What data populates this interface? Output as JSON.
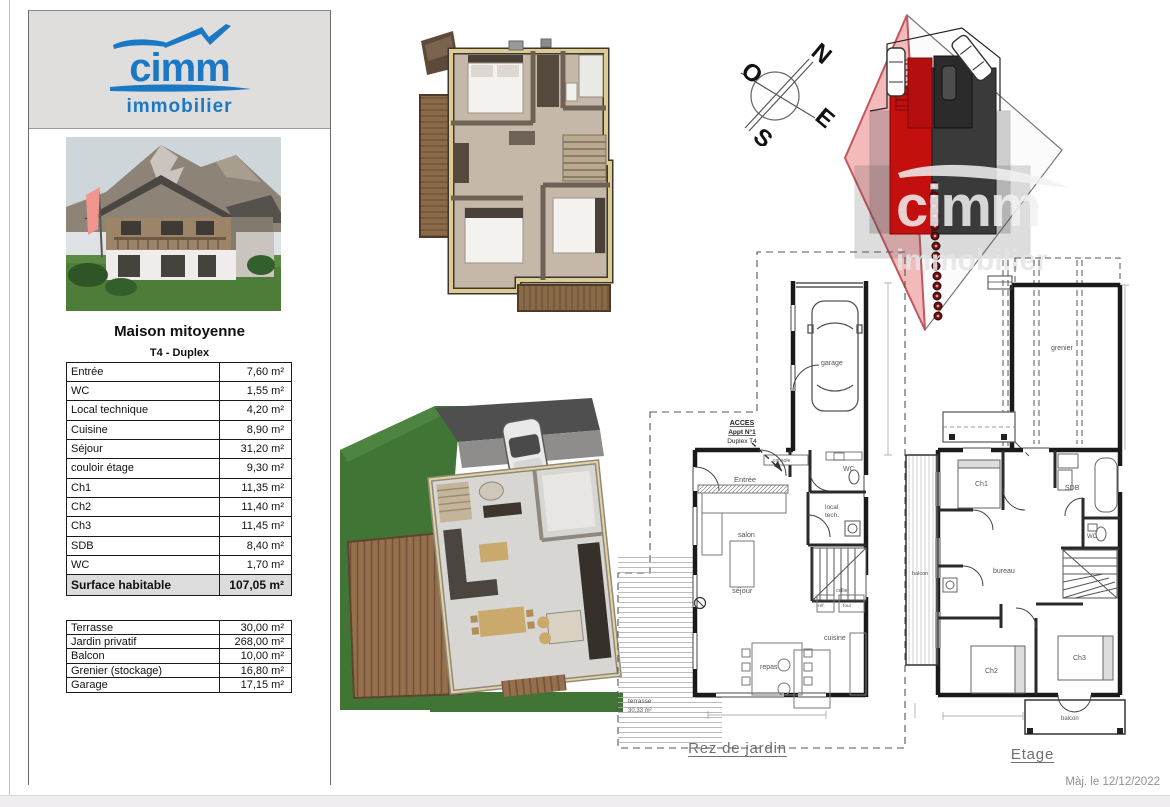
{
  "page": {
    "footer_date": "Màj. le 12/12/2022"
  },
  "brand": {
    "name": "cimm",
    "tagline": "immobilier"
  },
  "colors": {
    "brand_blue": "#1b78c4",
    "highlight_red": "#c40f0f",
    "parcel_pink": "#f3babc"
  },
  "listing": {
    "title": "Maison mitoyenne",
    "subtitle": "T4 - Duplex",
    "rooms": [
      {
        "label": "Entrée",
        "area": "7,60 m²"
      },
      {
        "label": "WC",
        "area": "1,55 m²"
      },
      {
        "label": "Local technique",
        "area": "4,20 m²"
      },
      {
        "label": "Cuisine",
        "area": "8,90 m²"
      },
      {
        "label": "Séjour",
        "area": "31,20 m²"
      },
      {
        "label": "couloir étage",
        "area": "9,30 m²"
      },
      {
        "label": "Ch1",
        "area": "11,35 m²"
      },
      {
        "label": "Ch2",
        "area": "11,40 m²"
      },
      {
        "label": "Ch3",
        "area": "11,45 m²"
      },
      {
        "label": "SDB",
        "area": "8,40 m²"
      },
      {
        "label": "WC",
        "area": "1,70 m²"
      }
    ],
    "total": {
      "label": "Surface habitable",
      "area": "107,05 m²"
    },
    "annexes": [
      {
        "label": "Terrasse",
        "area": "30,00 m²"
      },
      {
        "label": "Jardin privatif",
        "area": "268,00 m²"
      },
      {
        "label": "Balcon",
        "area": "10,00 m²"
      },
      {
        "label": "Grenier (stockage)",
        "area": "16,80 m²"
      },
      {
        "label": "Garage",
        "area": "17,15 m²"
      }
    ]
  },
  "compass": {
    "n": "N",
    "o": "O",
    "e": "E",
    "s": "S"
  },
  "site_plan": {
    "watermark": "cimm",
    "watermark2": "immobilier"
  },
  "plan_rez": {
    "caption": "Rez de jardin",
    "acces_line1": "ACCES",
    "acces_line2": "Appt N°1",
    "acces_line3": "Duplex T4",
    "rooms": {
      "garage": "garage",
      "entree": "Entrée",
      "console": "console",
      "wc": "WC",
      "local_tech1": "local",
      "local_tech2": "tech.",
      "salon": "salon",
      "sejour": "séjour",
      "repas": "repas",
      "cuisine": "cuisine",
      "cellier": "cellier",
      "ref": "réf.",
      "four": "four",
      "terrasse": "terrasse",
      "terrasse_area": "30,33 m²"
    }
  },
  "plan_etage": {
    "caption": "Etage",
    "rooms": {
      "grenier": "grenier",
      "ch1": "Ch1",
      "sdb": "SDB",
      "wc": "WC",
      "bureau": "bureau",
      "balcon_left": "balcon",
      "ch2": "Ch2",
      "ch3": "Ch3",
      "balcon_bottom": "balcon"
    }
  }
}
